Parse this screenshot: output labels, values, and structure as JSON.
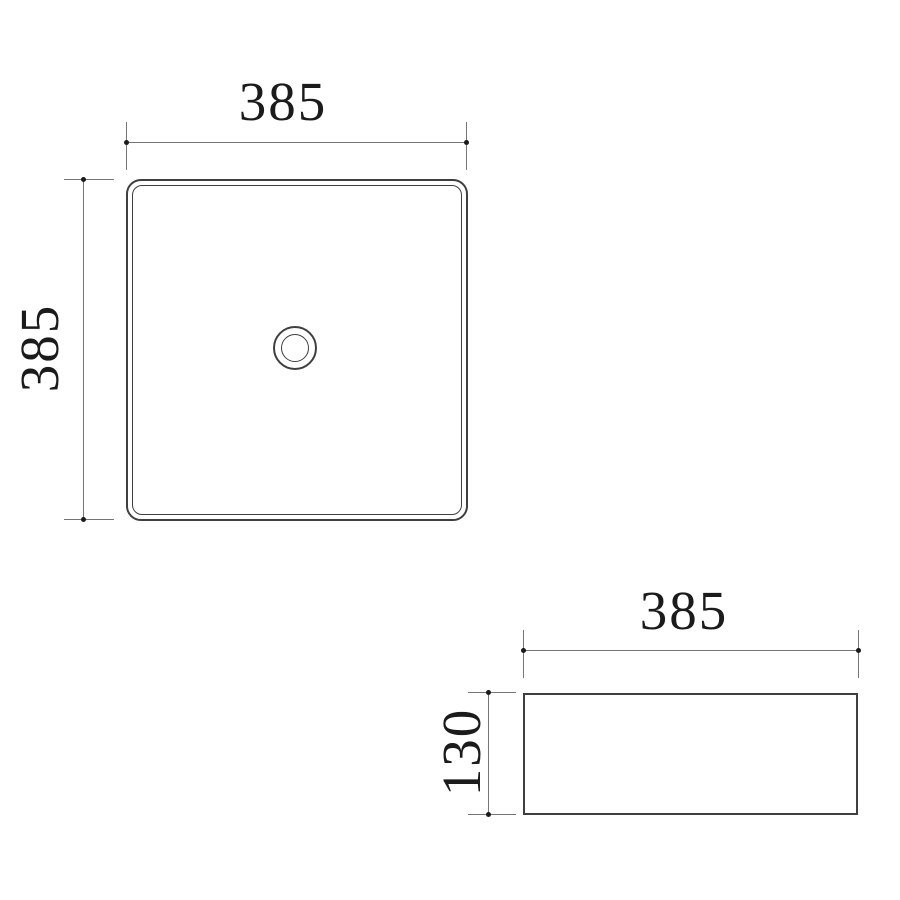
{
  "colors": {
    "background": "#ffffff",
    "object_line": "#3f3f3f",
    "dimension_line": "#757575",
    "dimension_dot": "#1a1a1a",
    "text": "#1b1b1b"
  },
  "views": {
    "top": {
      "width_label": "385",
      "height_label": "385"
    },
    "side": {
      "width_label": "385",
      "height_label": "130"
    }
  }
}
